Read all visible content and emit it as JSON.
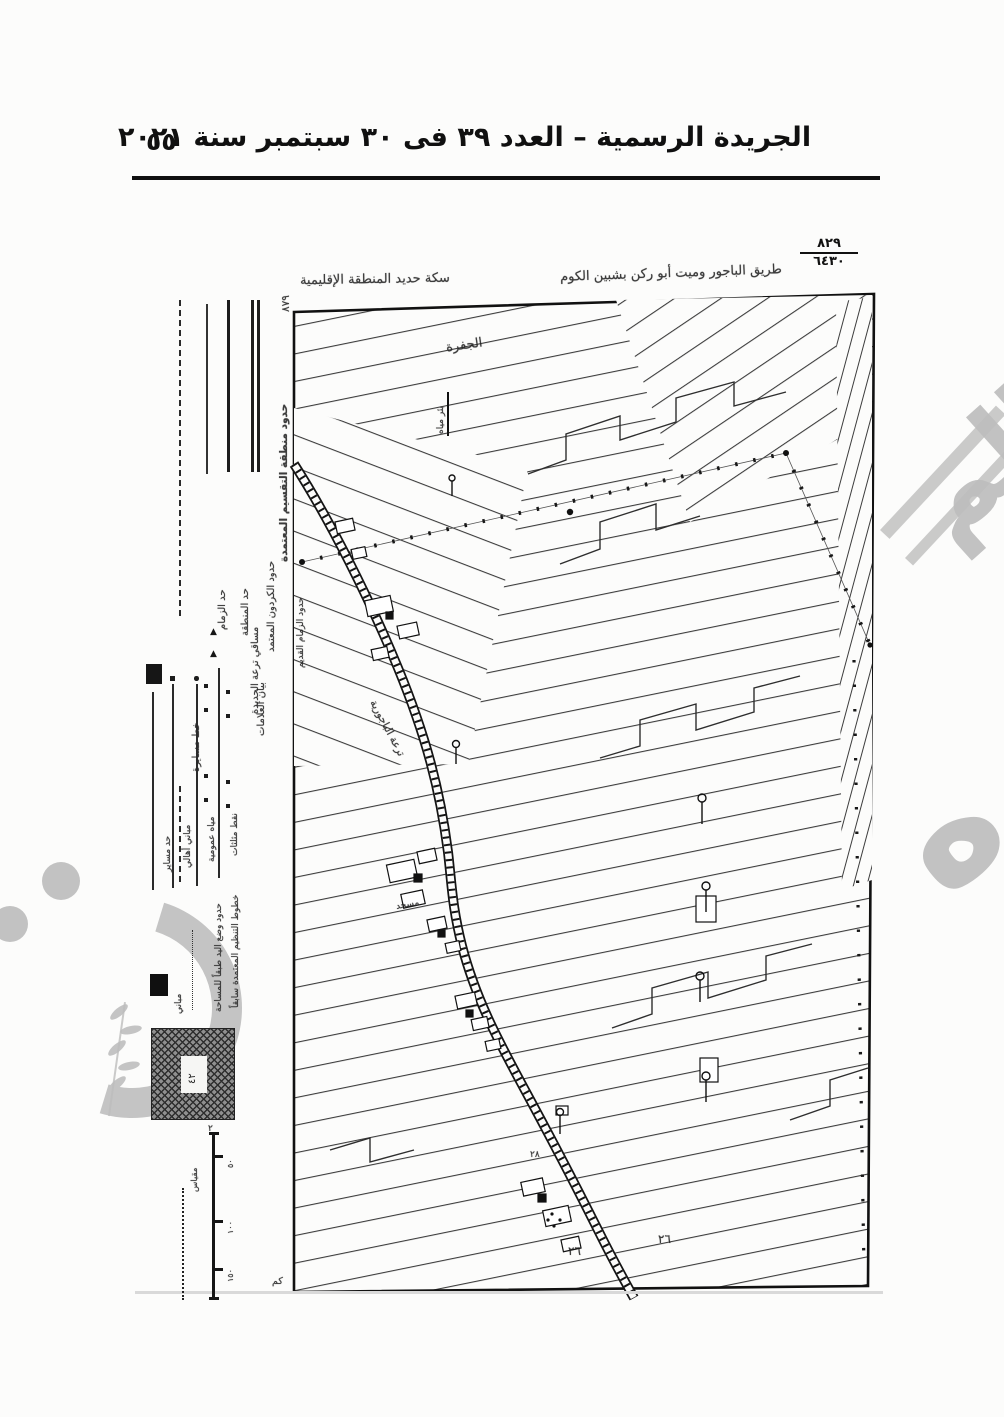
{
  "header": {
    "title": "الجريدة الرسمية – العدد ٣٩ فى ٣٠ سبتمبر سنة ٢٠٢١",
    "page_number": "٥٥"
  },
  "map": {
    "ref_fraction": {
      "numerator": "٨٢٩",
      "denominator": "٦٤٣٠"
    },
    "corner_number": "٨٧٩",
    "top_labels": {
      "railway": "سكة حديد المنطقة الإقليمية",
      "road": "طريق الباجور وميت أبو ركن بشبين الكوم"
    },
    "outer_left_labels": {
      "canal": "مساقي ترعة الجديدة",
      "boundary": "حدود الزمام القديم"
    },
    "field_labels": {
      "hamlet": "الجفرة",
      "well": "بئر مياه",
      "canal_road": "ترعة الباجورية",
      "mosque": "مسجد",
      "plot_a": "٢٦",
      "plot_b": "٢٦",
      "plot_c": "٢٨"
    }
  },
  "legend": {
    "header": "حدود منطقة التقسيم المعتمدة",
    "boundaries": [
      {
        "label": "حدود الكردون المعتمد",
        "style": "double"
      },
      {
        "label": "حد المنطقة",
        "style": "thick"
      },
      {
        "label": "حد الزمام",
        "style": "thin"
      },
      {
        "label": "خط مسايرة",
        "style": "dashed"
      }
    ],
    "symbols_header": "بيان العلامات",
    "symbols": [
      {
        "label": "نقط مثلثات"
      },
      {
        "label": "مياه عمومية"
      },
      {
        "label": "مباني أهالي"
      },
      {
        "label": "حد مساير"
      }
    ],
    "notes": [
      "خطوط التنظيم المعتمدة سابقاً",
      "حدود وضع اليد طبقاً للمساحة"
    ],
    "block_label": "مباني",
    "stamp_text": "٤٢",
    "stamp_note": "٢",
    "scale": {
      "title": "مقياس",
      "unit": "كم",
      "ticks": [
        "٥٠",
        "١٠٠",
        "١٥٠"
      ]
    }
  },
  "watermark": {
    "big_word": "صوره",
    "partial_word": "الم"
  }
}
